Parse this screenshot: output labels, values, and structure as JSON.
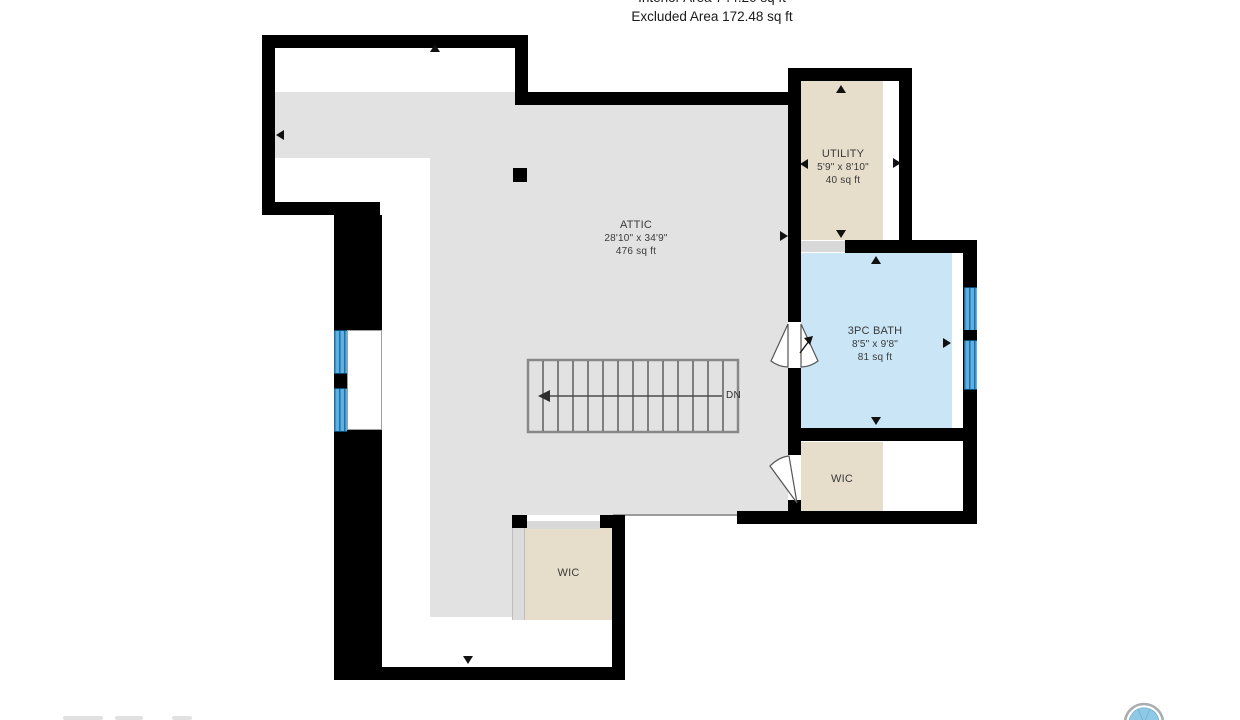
{
  "header": {
    "interior_area": "Interior Area 744.20 sq ft",
    "excluded_area": "Excluded Area 172.48 sq ft"
  },
  "rooms": {
    "attic": {
      "name": "ATTIC",
      "dims": "28'10\" x 34'9\"",
      "area": "476 sq ft"
    },
    "utility": {
      "name": "UTILITY",
      "dims": "5'9\" x 8'10\"",
      "area": "40 sq ft"
    },
    "bath": {
      "name": "3PC BATH",
      "dims": "8'5\" x 9'8\"",
      "area": "81 sq ft"
    },
    "wic_right": {
      "name": "WIC"
    },
    "wic_bottom": {
      "name": "WIC"
    }
  },
  "stairs": {
    "direction_label": "DN"
  },
  "colors": {
    "wall": "#000000",
    "floor": "#e2e2e2",
    "room_beige": "#e6decb",
    "bath_blue": "#cae5f5",
    "window_blue": "#5fb0e0",
    "window_stripe": "#1e6fa6",
    "threshold": "#d8d8d8",
    "stair_line": "#4a4a4a",
    "label_text": "#3a3a3a",
    "logo_blue": "#8ecae6",
    "logo_ring": "#a9adb2"
  }
}
